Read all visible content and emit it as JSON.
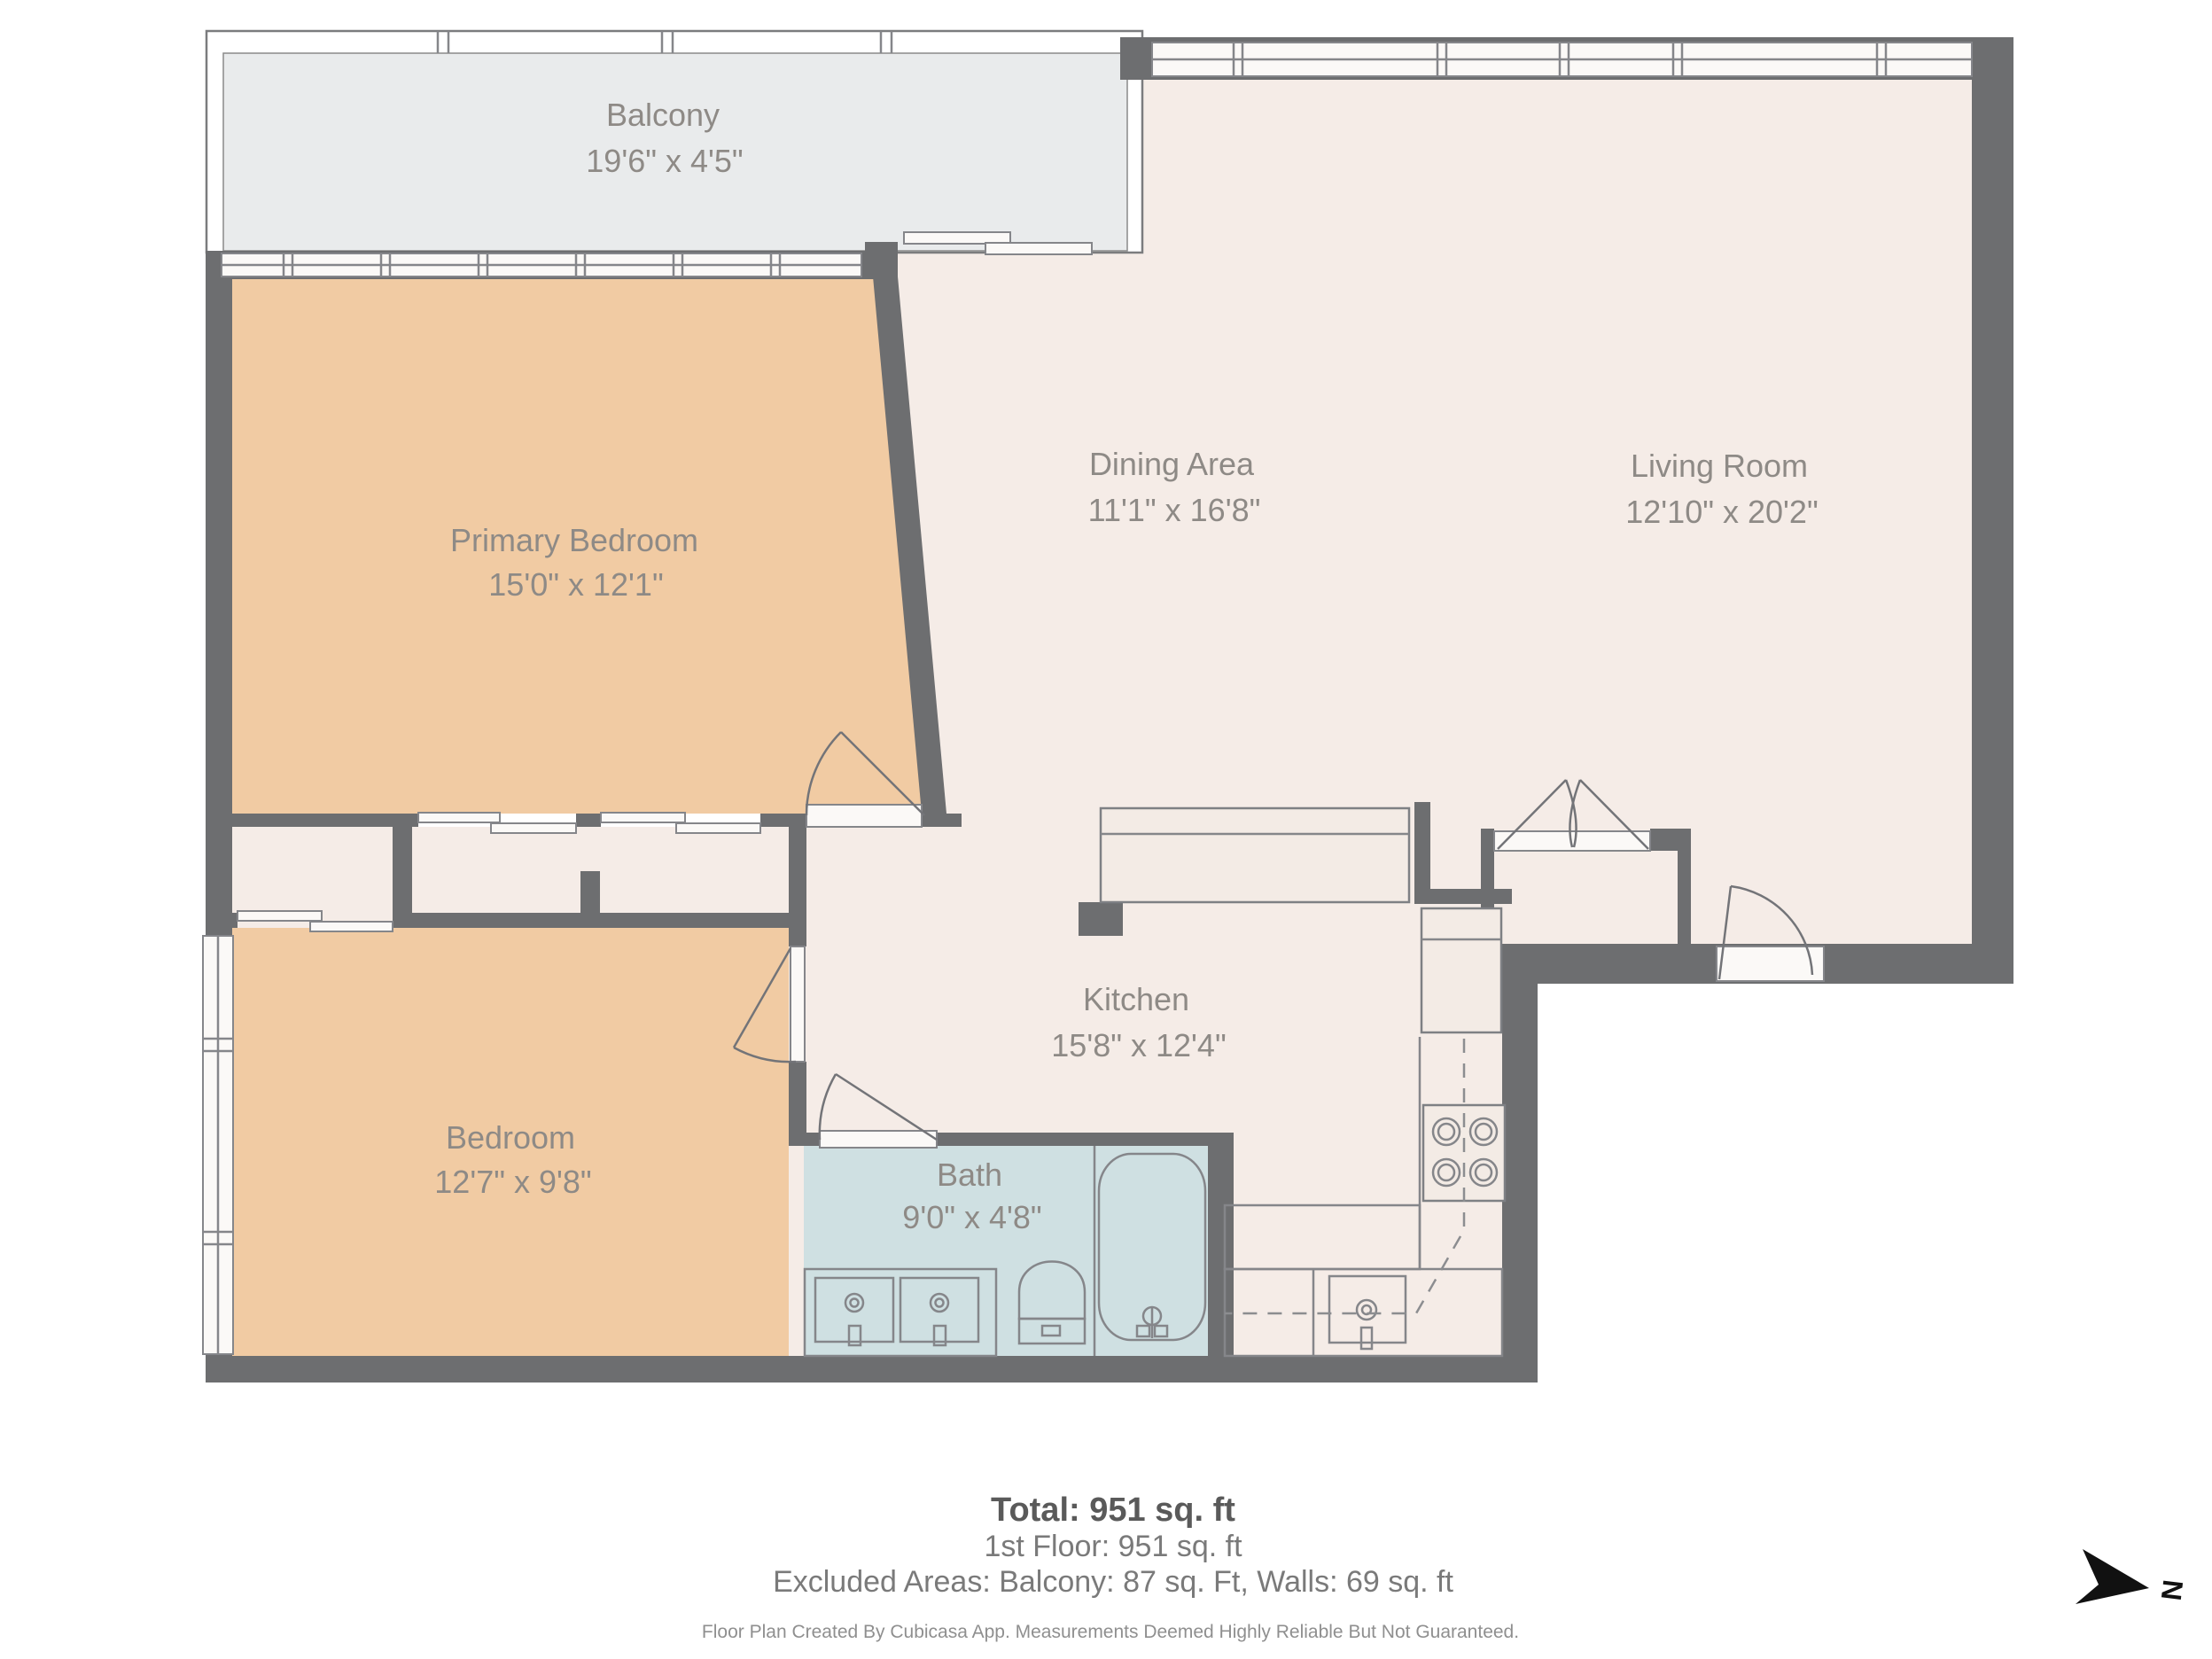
{
  "title": "Floor plan",
  "rooms": [
    {
      "name": "Balcony",
      "dimensions": "19'6\" x 4'5\""
    },
    {
      "name": "Primary Bedroom",
      "dimensions": "15'0\" x 12'1\""
    },
    {
      "name": "Dining Area",
      "dimensions": "11'1\" x 16'8\""
    },
    {
      "name": "Living Room",
      "dimensions": "12'10\" x 20'2\""
    },
    {
      "name": "Bedroom",
      "dimensions": "12'7\" x 9'8\""
    },
    {
      "name": "Kitchen",
      "dimensions": "15'8\" x 12'4\""
    },
    {
      "name": "Bath",
      "dimensions": "9'0\" x 4'8\""
    }
  ],
  "summary": {
    "total": "Total: 951 sq. ft",
    "first_floor": "1st Floor: 951 sq. ft",
    "excluded": "Excluded Areas: Balcony: 87 sq. Ft, Walls: 69 sq. ft",
    "disclaimer": "Floor Plan Created By Cubicasa App. Measurements Deemed Highly Reliable But Not Guaranteed."
  },
  "compass": {
    "label": "N"
  },
  "colors": {
    "wall": "#6d6e70",
    "floor_main": "#f5ece7",
    "floor_bedroom": "#f1cba3",
    "floor_bath": "#cfe0e2",
    "floor_balcony": "#e9ebec",
    "label_text": "#8e8a86"
  }
}
